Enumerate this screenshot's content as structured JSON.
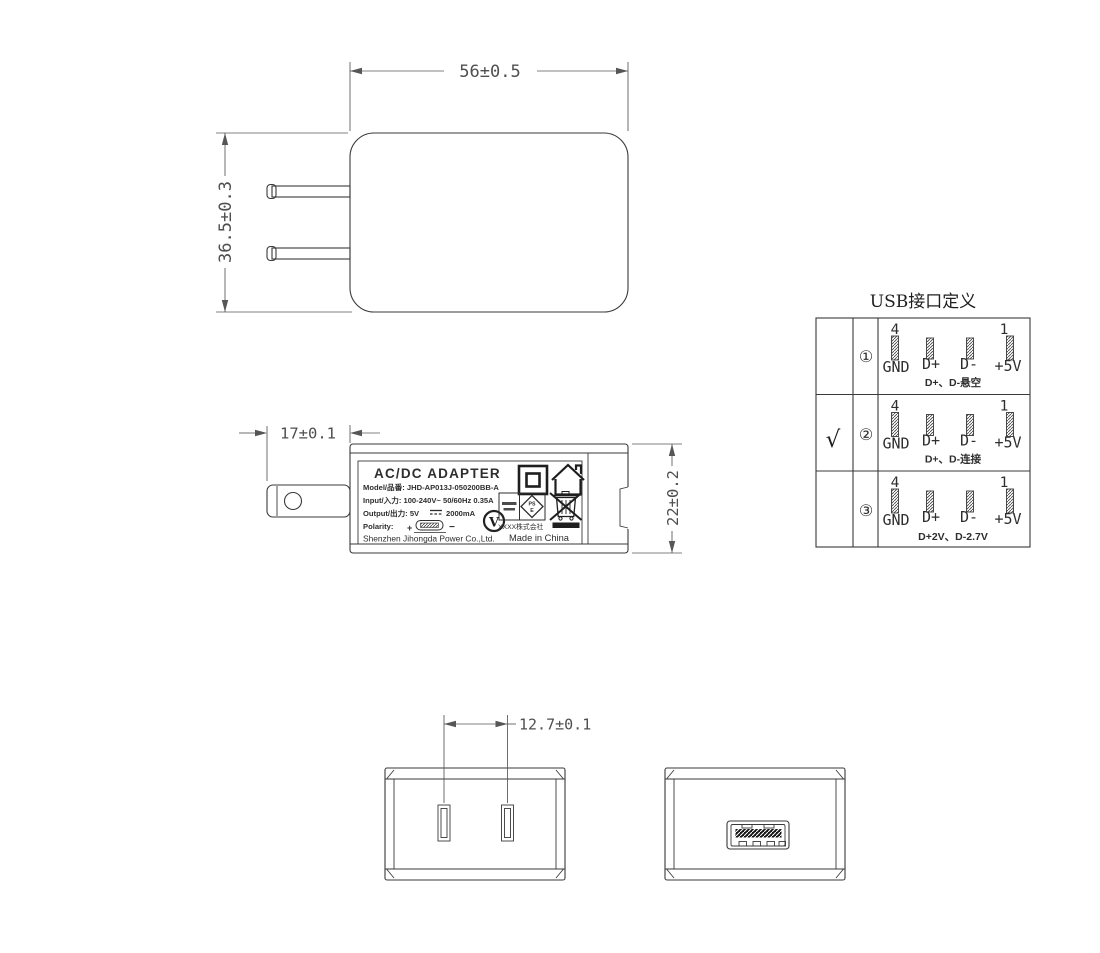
{
  "drawing_title": "AC/DC adapter outline drawing",
  "colors": {
    "line": "#3a3a3a",
    "dimension": "#4f4f4f",
    "background": "#ffffff",
    "contact_bar": "#161616"
  },
  "dimensions": {
    "body_width": "56±0.5",
    "body_height": "36.5±0.3",
    "prong_length": "17±0.1",
    "body_depth": "22±0.2",
    "pin_pitch": "12.7±0.1"
  },
  "label": {
    "title": "AC/DC  ADAPTER",
    "model": "Model/品番: JHD-AP013J-050200BB-A",
    "input": "Input/入力: 100-240V~  50/60Hz  0.35A",
    "output_prefix": "Output/出力: 5V",
    "output_suffix": "2000mA",
    "polarity": "Polarity:",
    "polarity_plus": "+",
    "polarity_minus": "−",
    "company": "Shenzhen Jihongda Power Co.,Ltd.",
    "efficiency_mark": "V",
    "pse_top": "PS",
    "pse_bottom": "E",
    "pse_company": "XXXX株式会社",
    "made_in": "Made in China"
  },
  "usb_table": {
    "title": "USB接口定义",
    "pin_left_num": "4",
    "pin_right_num": "1",
    "pin_labels": [
      "GND",
      "D+",
      "D-",
      "+5V"
    ],
    "rows": [
      {
        "check": "",
        "num": "①",
        "caption": "D+、D-悬空"
      },
      {
        "check": "√",
        "num": "②",
        "caption": "D+、D-连接"
      },
      {
        "check": "",
        "num": "③",
        "caption": "D+2V、D-2.7V"
      }
    ]
  }
}
